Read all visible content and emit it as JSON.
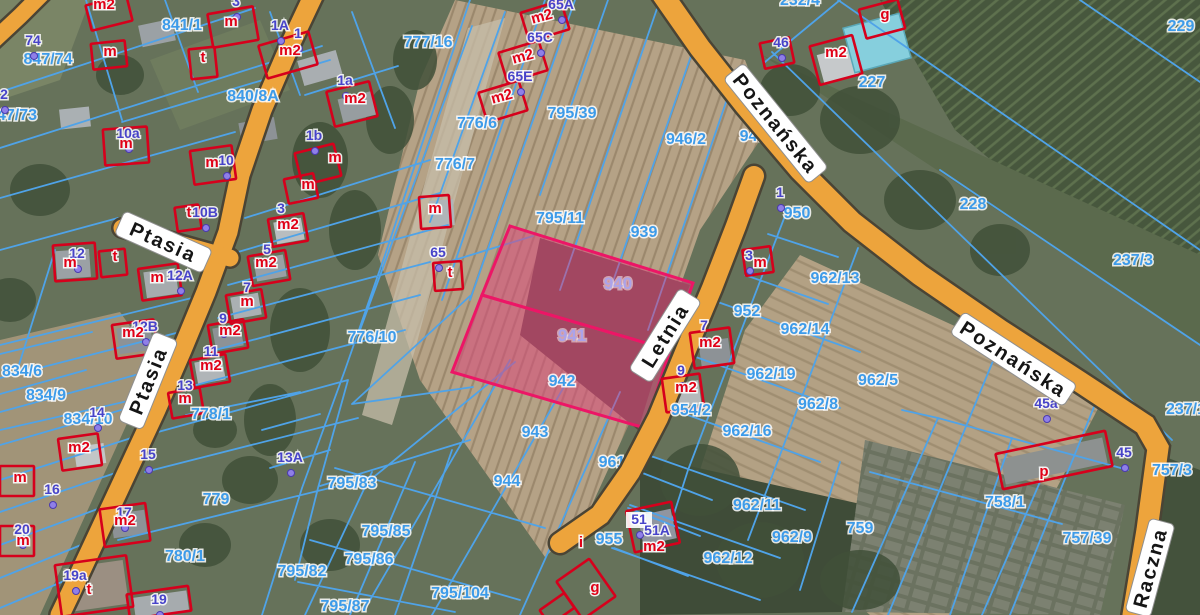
{
  "map": {
    "colors": {
      "road_fill": "#EDA43C",
      "road_casing": "#4a4435",
      "parcel_line": "#4FA3E8",
      "parcel_label": "#3D9BE9",
      "highlight_border": "#EC1666",
      "highlight_fill": "rgba(219,72,124,0.55)",
      "highlight_label": "#ABA3EA",
      "house_number": "#4743C9",
      "address_dot": "#8F7FE8",
      "building_outline": "#D6001C",
      "building_label": "#E00016",
      "street_text": "#151515",
      "street_pill": "#ffffff"
    },
    "streets": [
      {
        "name": "Poznańska",
        "x": 775,
        "y": 124,
        "rot": 51
      },
      {
        "name": "Poznańska",
        "x": 1013,
        "y": 360,
        "rot": 33
      },
      {
        "name": "Letnia",
        "x": 666,
        "y": 336,
        "rot": -58
      },
      {
        "name": "Ptasia",
        "x": 163,
        "y": 243,
        "rot": 24
      },
      {
        "name": "Ptasia",
        "x": 149,
        "y": 381,
        "rot": -68
      },
      {
        "name": "Raczna",
        "x": 1151,
        "y": 568,
        "rot": -75
      }
    ],
    "highlighted_parcels": [
      {
        "number": "940",
        "x": 618,
        "y": 289
      },
      {
        "number": "941",
        "x": 572,
        "y": 341
      }
    ],
    "parcel_labels": [
      {
        "t": "841/1",
        "x": 182,
        "y": 30
      },
      {
        "t": "847/74",
        "x": 48,
        "y": 64
      },
      {
        "t": "47/73",
        "x": 17,
        "y": 120
      },
      {
        "t": "777/16",
        "x": 428,
        "y": 47
      },
      {
        "t": "840/8A",
        "x": 253,
        "y": 101
      },
      {
        "t": "776/6",
        "x": 477,
        "y": 128
      },
      {
        "t": "776/7",
        "x": 455,
        "y": 169
      },
      {
        "t": "795/39",
        "x": 572,
        "y": 118
      },
      {
        "t": "946/2",
        "x": 686,
        "y": 144
      },
      {
        "t": "795/11",
        "x": 560,
        "y": 223
      },
      {
        "t": "939",
        "x": 644,
        "y": 237
      },
      {
        "t": "942",
        "x": 562,
        "y": 386
      },
      {
        "t": "943",
        "x": 535,
        "y": 437
      },
      {
        "t": "944",
        "x": 507,
        "y": 486
      },
      {
        "t": "955",
        "x": 609,
        "y": 544
      },
      {
        "t": "795/83",
        "x": 352,
        "y": 488
      },
      {
        "t": "795/85",
        "x": 386,
        "y": 536
      },
      {
        "t": "795/86",
        "x": 369,
        "y": 564
      },
      {
        "t": "795/82",
        "x": 302,
        "y": 576
      },
      {
        "t": "795/87",
        "x": 345,
        "y": 611
      },
      {
        "t": "795/104",
        "x": 460,
        "y": 598
      },
      {
        "t": "778/1",
        "x": 211,
        "y": 419
      },
      {
        "t": "779",
        "x": 216,
        "y": 504
      },
      {
        "t": "780/1",
        "x": 185,
        "y": 561
      },
      {
        "t": "834/6",
        "x": 22,
        "y": 376
      },
      {
        "t": "834/9",
        "x": 46,
        "y": 400
      },
      {
        "t": "834/10",
        "x": 88,
        "y": 424
      },
      {
        "t": "776/10",
        "x": 372,
        "y": 342
      },
      {
        "t": "228",
        "x": 973,
        "y": 209
      },
      {
        "t": "229",
        "x": 1181,
        "y": 31
      },
      {
        "t": "227",
        "x": 872,
        "y": 87
      },
      {
        "t": "232/4",
        "x": 800,
        "y": 5
      },
      {
        "t": "237/3",
        "x": 1133,
        "y": 265
      },
      {
        "t": "237/1",
        "x": 1186,
        "y": 414
      },
      {
        "t": "757/3",
        "x": 1172,
        "y": 475
      },
      {
        "t": "757/39",
        "x": 1087,
        "y": 543
      },
      {
        "t": "758/1",
        "x": 1005,
        "y": 507
      },
      {
        "t": "759",
        "x": 860,
        "y": 533
      },
      {
        "t": "962/8",
        "x": 818,
        "y": 409
      },
      {
        "t": "962/5",
        "x": 878,
        "y": 385
      },
      {
        "t": "962/13",
        "x": 835,
        "y": 283
      },
      {
        "t": "962/14",
        "x": 805,
        "y": 334
      },
      {
        "t": "952",
        "x": 747,
        "y": 316
      },
      {
        "t": "962/19",
        "x": 771,
        "y": 379
      },
      {
        "t": "962/16",
        "x": 747,
        "y": 436
      },
      {
        "t": "954/2",
        "x": 691,
        "y": 415
      },
      {
        "t": "962/11",
        "x": 757,
        "y": 510
      },
      {
        "t": "962/9",
        "x": 792,
        "y": 542
      },
      {
        "t": "962/12",
        "x": 728,
        "y": 563
      },
      {
        "t": "950",
        "x": 797,
        "y": 218
      }
    ],
    "parcel_labels_under_road": [
      {
        "t": "947",
        "x": 753,
        "y": 141
      },
      {
        "t": "961",
        "x": 612,
        "y": 467
      }
    ],
    "house_numbers": [
      {
        "t": "74",
        "x": 33,
        "y": 45
      },
      {
        "t": "2",
        "x": 4,
        "y": 99
      },
      {
        "t": "3",
        "x": 236,
        "y": 6
      },
      {
        "t": "1A",
        "x": 280,
        "y": 30
      },
      {
        "t": "1",
        "x": 298,
        "y": 38
      },
      {
        "t": "1a",
        "x": 345,
        "y": 85
      },
      {
        "t": "1b",
        "x": 314,
        "y": 140
      },
      {
        "t": "10a",
        "x": 128,
        "y": 138
      },
      {
        "t": "10",
        "x": 226,
        "y": 165
      },
      {
        "t": "10B",
        "x": 205,
        "y": 217
      },
      {
        "t": "12",
        "x": 77,
        "y": 258
      },
      {
        "t": "12A",
        "x": 180,
        "y": 280
      },
      {
        "t": "12B",
        "x": 145,
        "y": 331
      },
      {
        "t": "3",
        "x": 281,
        "y": 213
      },
      {
        "t": "5",
        "x": 267,
        "y": 254
      },
      {
        "t": "7",
        "x": 247,
        "y": 292
      },
      {
        "t": "9",
        "x": 223,
        "y": 323
      },
      {
        "t": "11",
        "x": 211,
        "y": 356
      },
      {
        "t": "13",
        "x": 185,
        "y": 390
      },
      {
        "t": "13A",
        "x": 290,
        "y": 462
      },
      {
        "t": "14",
        "x": 97,
        "y": 417
      },
      {
        "t": "15",
        "x": 148,
        "y": 459
      },
      {
        "t": "16",
        "x": 52,
        "y": 494
      },
      {
        "t": "17",
        "x": 124,
        "y": 517
      },
      {
        "t": "20",
        "x": 22,
        "y": 534
      },
      {
        "t": "19a",
        "x": 75,
        "y": 580
      },
      {
        "t": "19",
        "x": 159,
        "y": 604
      },
      {
        "t": "65",
        "x": 438,
        "y": 257
      },
      {
        "t": "65A",
        "x": 561,
        "y": 9
      },
      {
        "t": "65C",
        "x": 540,
        "y": 42
      },
      {
        "t": "65E",
        "x": 520,
        "y": 81
      },
      {
        "t": "46",
        "x": 781,
        "y": 47
      },
      {
        "t": "1",
        "x": 780,
        "y": 197
      },
      {
        "t": "3",
        "x": 749,
        "y": 260
      },
      {
        "t": "7",
        "x": 704,
        "y": 330
      },
      {
        "t": "9",
        "x": 681,
        "y": 375
      },
      {
        "t": "51",
        "x": 639,
        "y": 524,
        "bg": true
      },
      {
        "t": "51A",
        "x": 657,
        "y": 535
      },
      {
        "t": "45a",
        "x": 1046,
        "y": 408
      },
      {
        "t": "45",
        "x": 1124,
        "y": 457
      }
    ],
    "building_labels": [
      {
        "t": "m2",
        "x": 104,
        "y": 9
      },
      {
        "t": "m",
        "x": 110,
        "y": 56
      },
      {
        "t": "m",
        "x": 231,
        "y": 26
      },
      {
        "t": "t",
        "x": 203,
        "y": 62
      },
      {
        "t": "m2",
        "x": 290,
        "y": 55
      },
      {
        "t": "m2",
        "x": 355,
        "y": 103
      },
      {
        "t": "m",
        "x": 335,
        "y": 162
      },
      {
        "t": "m",
        "x": 308,
        "y": 189
      },
      {
        "t": "m",
        "x": 212,
        "y": 167
      },
      {
        "t": "m",
        "x": 126,
        "y": 148
      },
      {
        "t": "m2",
        "x": 543,
        "y": 21,
        "rot": -15
      },
      {
        "t": "m2",
        "x": 524,
        "y": 61,
        "rot": -15
      },
      {
        "t": "m2",
        "x": 503,
        "y": 101,
        "rot": -15
      },
      {
        "t": "g",
        "x": 885,
        "y": 19
      },
      {
        "t": "m2",
        "x": 836,
        "y": 57
      },
      {
        "t": "t",
        "x": 189,
        "y": 217
      },
      {
        "t": "m2",
        "x": 288,
        "y": 229
      },
      {
        "t": "m2",
        "x": 266,
        "y": 267
      },
      {
        "t": "m",
        "x": 247,
        "y": 306
      },
      {
        "t": "m2",
        "x": 230,
        "y": 335
      },
      {
        "t": "m2",
        "x": 211,
        "y": 370
      },
      {
        "t": "m",
        "x": 185,
        "y": 403
      },
      {
        "t": "t",
        "x": 115,
        "y": 261
      },
      {
        "t": "m",
        "x": 70,
        "y": 267
      },
      {
        "t": "m",
        "x": 157,
        "y": 282
      },
      {
        "t": "m2",
        "x": 133,
        "y": 337
      },
      {
        "t": "m",
        "x": 435,
        "y": 213
      },
      {
        "t": "t",
        "x": 450,
        "y": 277
      },
      {
        "t": "m2",
        "x": 79,
        "y": 452
      },
      {
        "t": "m",
        "x": 20,
        "y": 482
      },
      {
        "t": "m2",
        "x": 125,
        "y": 525
      },
      {
        "t": "m",
        "x": 23,
        "y": 545
      },
      {
        "t": "t",
        "x": 89,
        "y": 594
      },
      {
        "t": "m",
        "x": 760,
        "y": 267
      },
      {
        "t": "m2",
        "x": 710,
        "y": 347
      },
      {
        "t": "m2",
        "x": 686,
        "y": 392
      },
      {
        "t": "m2",
        "x": 654,
        "y": 551
      },
      {
        "t": "i",
        "x": 581,
        "y": 547
      },
      {
        "t": "g",
        "x": 595,
        "y": 592
      },
      {
        "t": "p",
        "x": 1044,
        "y": 476
      }
    ]
  }
}
